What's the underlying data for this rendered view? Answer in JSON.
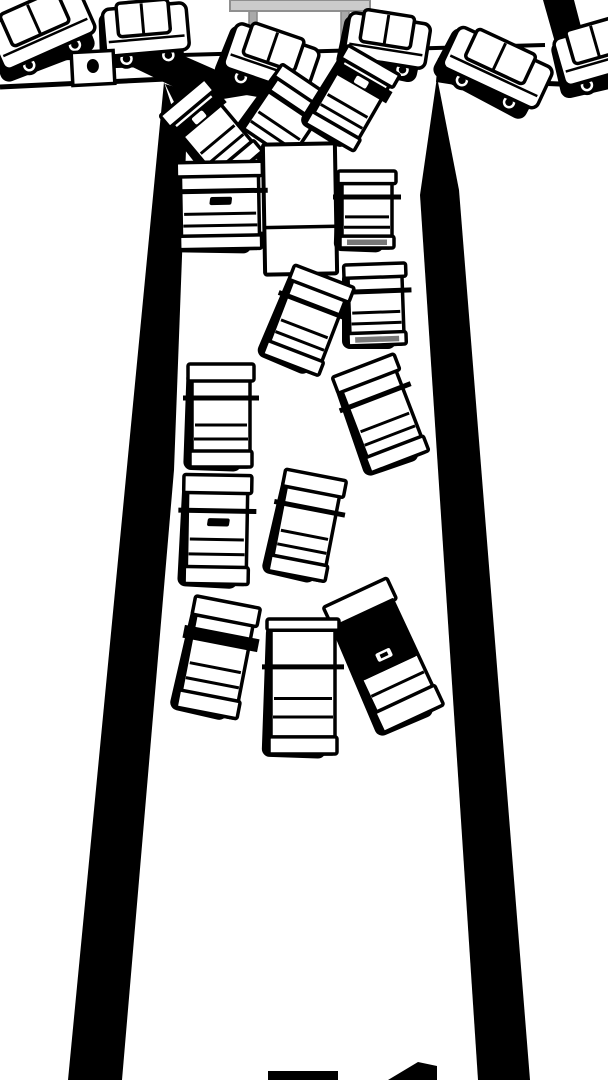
{
  "scene": {
    "width": 608,
    "height": 1080
  },
  "palette": {
    "ink": "#000000",
    "paper": "#ffffff",
    "bumper_gray": "#787878",
    "sign_bar_fill": "#cbcbcb",
    "sign_bar_stroke": "#8f8f8f",
    "sign_leg_fill": "#a9a9a9",
    "sign_leg_stroke": "#878787"
  },
  "sign": {
    "bar": {
      "x": 230,
      "y": 0,
      "w": 140,
      "h": 11
    },
    "legs": [
      {
        "x": 249,
        "y": 11,
        "w": 8,
        "h": 39
      },
      {
        "x": 341,
        "y": 11,
        "w": 8,
        "h": 39
      }
    ]
  },
  "street_lines": [
    {
      "name": "cross-street-far-edge",
      "x1": 0,
      "y1": 60,
      "x2": 545,
      "y2": 45,
      "w": 4
    },
    {
      "name": "cross-street-far-edge-right",
      "x1": 556,
      "y1": 46,
      "x2": 608,
      "y2": 49,
      "w": 4
    },
    {
      "name": "cross-street-near-edge-left",
      "x1": 0,
      "y1": 87,
      "x2": 166,
      "y2": 79,
      "w": 5
    },
    {
      "name": "cross-street-near-edge-right",
      "x1": 437,
      "y1": 79,
      "x2": 608,
      "y2": 86,
      "w": 5
    }
  ],
  "walls": [
    {
      "name": "upper-right-wall",
      "points": [
        [
          543,
          0
        ],
        [
          574,
          0
        ],
        [
          586,
          46
        ],
        [
          556,
          46
        ]
      ]
    },
    {
      "name": "left-wall",
      "points": [
        [
          164,
          82
        ],
        [
          186,
          150
        ],
        [
          174,
          470
        ],
        [
          122,
          1080
        ],
        [
          68,
          1080
        ]
      ]
    },
    {
      "name": "right-wall",
      "points": [
        [
          437,
          77
        ],
        [
          459,
          190
        ],
        [
          530,
          1080
        ],
        [
          478,
          1080
        ],
        [
          420,
          195
        ]
      ]
    }
  ],
  "shadow_blobs_under": [
    {
      "name": "shadow-under-box-truck",
      "points": [
        [
          118,
          60
        ],
        [
          175,
          52
        ],
        [
          266,
          92
        ],
        [
          205,
          102
        ]
      ]
    },
    {
      "name": "shadow-right-corner",
      "points": [
        [
          438,
          58
        ],
        [
          506,
          68
        ],
        [
          500,
          92
        ],
        [
          436,
          82
        ]
      ]
    },
    {
      "name": "shadow-under-van",
      "points": [
        [
          246,
          76
        ],
        [
          310,
          84
        ],
        [
          300,
          104
        ],
        [
          240,
          94
        ]
      ]
    }
  ],
  "shadow_blobs_over": [
    {
      "name": "shadow-left-corner-smear",
      "points": [
        [
          165,
          84
        ],
        [
          214,
          98
        ],
        [
          242,
          162
        ],
        [
          190,
          134
        ]
      ]
    },
    {
      "name": "shadow-jam-right",
      "points": [
        [
          322,
          104
        ],
        [
          360,
          118
        ],
        [
          350,
          136
        ],
        [
          318,
          126
        ]
      ]
    }
  ],
  "cross_traffic_cars": [
    {
      "id": "cross-car-1",
      "cx": 42,
      "cy": 30,
      "w": 100,
      "h": 58,
      "rot": -24
    },
    {
      "id": "cross-car-2",
      "cx": 146,
      "cy": 31,
      "w": 84,
      "h": 56,
      "rot": -5
    },
    {
      "id": "cross-van",
      "cx": 271,
      "cy": 60,
      "w": 88,
      "h": 56,
      "rot": 19
    },
    {
      "id": "cross-car-3",
      "cx": 387,
      "cy": 42,
      "w": 82,
      "h": 54,
      "rot": 9
    },
    {
      "id": "cross-car-4",
      "cx": 497,
      "cy": 69,
      "w": 104,
      "h": 54,
      "rot": 25
    },
    {
      "id": "cross-car-5",
      "cx": 601,
      "cy": 53,
      "w": 86,
      "h": 58,
      "rot": -16
    }
  ],
  "box_truck_rear": {
    "id": "box-truck-rear",
    "cx": 93,
    "cy": 68,
    "w": 42,
    "h": 33,
    "rot": -3
  },
  "delivery_truck": {
    "id": "delivery-truck",
    "cx": 300,
    "cy": 209,
    "w": 72,
    "h": 130,
    "rot": -1,
    "divider": 0.638
  },
  "road_cars": [
    {
      "id": "jam-car-left",
      "cx": 213,
      "cy": 134,
      "w": 50,
      "h": 90,
      "rot": -40,
      "variant": "blackband",
      "z": "pre-truck2"
    },
    {
      "id": "jam-car-center",
      "cx": 283,
      "cy": 120,
      "w": 56,
      "h": 86,
      "rot": 34,
      "variant": "plain",
      "z": "pre-truck"
    },
    {
      "id": "jam-car-right",
      "cx": 351,
      "cy": 100,
      "w": 52,
      "h": 86,
      "rot": 30,
      "variant": "blackband",
      "z": "pre-truck"
    },
    {
      "id": "left-lane-1",
      "cx": 220,
      "cy": 207,
      "w": 78,
      "h": 84,
      "rot": -1,
      "variant": "blob"
    },
    {
      "id": "right-lane-1",
      "cx": 367,
      "cy": 211,
      "w": 50,
      "h": 74,
      "rot": 0,
      "variant": "graybump"
    },
    {
      "id": "right-lane-2",
      "cx": 376,
      "cy": 306,
      "w": 54,
      "h": 78,
      "rot": -2,
      "variant": "graybump"
    },
    {
      "id": "mid-tilted-1",
      "cx": 307,
      "cy": 322,
      "w": 56,
      "h": 92,
      "rot": 21,
      "variant": "plain"
    },
    {
      "id": "right-tilted",
      "cx": 382,
      "cy": 415,
      "w": 58,
      "h": 100,
      "rot": -21,
      "variant": "plain"
    },
    {
      "id": "left-lane-2",
      "cx": 221,
      "cy": 417,
      "w": 58,
      "h": 100,
      "rot": 0,
      "variant": "plain"
    },
    {
      "id": "left-lane-3",
      "cx": 217,
      "cy": 531,
      "w": 60,
      "h": 106,
      "rot": 1,
      "variant": "blob"
    },
    {
      "id": "mid-tilted-2",
      "cx": 306,
      "cy": 527,
      "w": 54,
      "h": 100,
      "rot": 11,
      "variant": "plain"
    },
    {
      "id": "bottom-left-car",
      "cx": 217,
      "cy": 659,
      "w": 58,
      "h": 110,
      "rot": 11,
      "variant": "blackband2"
    },
    {
      "id": "bottom-right-car",
      "cx": 385,
      "cy": 657,
      "w": 62,
      "h": 136,
      "rot": -25,
      "variant": "blackroof"
    },
    {
      "id": "bottom-mid-car",
      "cx": 303,
      "cy": 688,
      "w": 64,
      "h": 132,
      "rot": 0,
      "variant": "limo"
    }
  ],
  "bottom_pieces": [
    {
      "name": "entering-car-roof",
      "points": [
        [
          268,
          1071
        ],
        [
          338,
          1071
        ],
        [
          338,
          1080
        ],
        [
          268,
          1080
        ]
      ]
    },
    {
      "name": "entering-car-corner",
      "points": [
        [
          388,
          1080
        ],
        [
          418,
          1062
        ],
        [
          437,
          1066
        ],
        [
          437,
          1080
        ]
      ]
    }
  ]
}
